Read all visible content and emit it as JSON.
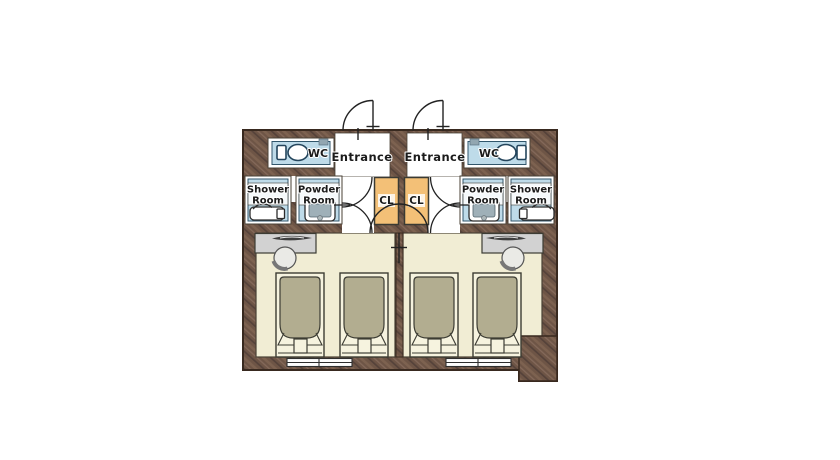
{
  "floor_plan": {
    "description": "Mirrored pair of twin guest-room units floor plan",
    "labels": {
      "wc": "WC",
      "entrance": "Entrance",
      "shower_line1": "Shower",
      "shower_line2": "Room",
      "powder_line1": "Powder",
      "powder_line2": "Room",
      "closet": "CL"
    },
    "colors": {
      "wall": "#6e5546",
      "wall_outline": "#38291f",
      "floor": "#f1edd4",
      "wet_room": "#bedbe9",
      "closet": "#f3c077",
      "bed_duvet": "#b2ad90",
      "bed_frame": "#f6f3df",
      "desk": "#d2d2d2",
      "fixture_outline": "#24455c",
      "door_line": "#222222"
    },
    "units": [
      {
        "id": "unit-left",
        "rooms": [
          "WC",
          "Entrance",
          "Shower Room",
          "Powder Room",
          "CL",
          "Bedroom"
        ],
        "beds": 2,
        "desks": 1,
        "chairs": 1,
        "windows": 1,
        "toilets": 1,
        "bathtubs": 1,
        "washbasins": 1
      },
      {
        "id": "unit-right",
        "rooms": [
          "WC",
          "Entrance",
          "Shower Room",
          "Powder Room",
          "CL",
          "Bedroom"
        ],
        "beds": 2,
        "desks": 1,
        "chairs": 1,
        "windows": 1,
        "toilets": 1,
        "bathtubs": 1,
        "washbasins": 1
      }
    ],
    "icons": [
      "toilet-icon",
      "bathtub-icon",
      "washbasin-icon",
      "bed-icon",
      "desk-icon",
      "chair-icon",
      "door-swing-icon",
      "window-icon",
      "closet-icon"
    ]
  }
}
